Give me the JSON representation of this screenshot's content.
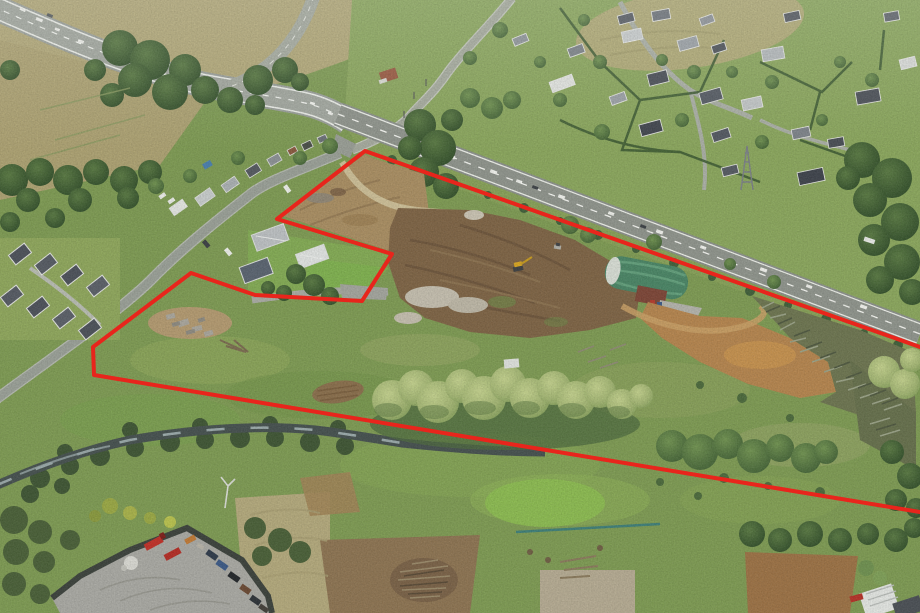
{
  "meta": {
    "title": "Aerial drone photograph of a semi-rural land parcel outlined in red",
    "image_width": 920,
    "image_height": 613
  },
  "boundary": {
    "color": "#e8251c",
    "stroke_width": "4",
    "points": "920,347 365,151 277,219 392,254 362,301 255,295 191,273 93,347 94,375 920,512"
  },
  "palette": {
    "grass_green": "#7e9b53",
    "bright_grass": "#8cbb51",
    "dry_grass": "#b2a878",
    "dark_trees": "#34512e",
    "willow_green": "#a2b572",
    "earthworks_brown": "#7e6445",
    "north_dirt_tan": "#a98e62",
    "clay_orange": "#b5854e",
    "road_asphalt": "#8f948c",
    "stream_water": "#46514f",
    "barn_green": "#4a8565",
    "shed_rust": "#7d4637",
    "yard_gravel": "#a9a9a3",
    "truck_red": "#c13128",
    "boundary_red": "#e8251c"
  }
}
